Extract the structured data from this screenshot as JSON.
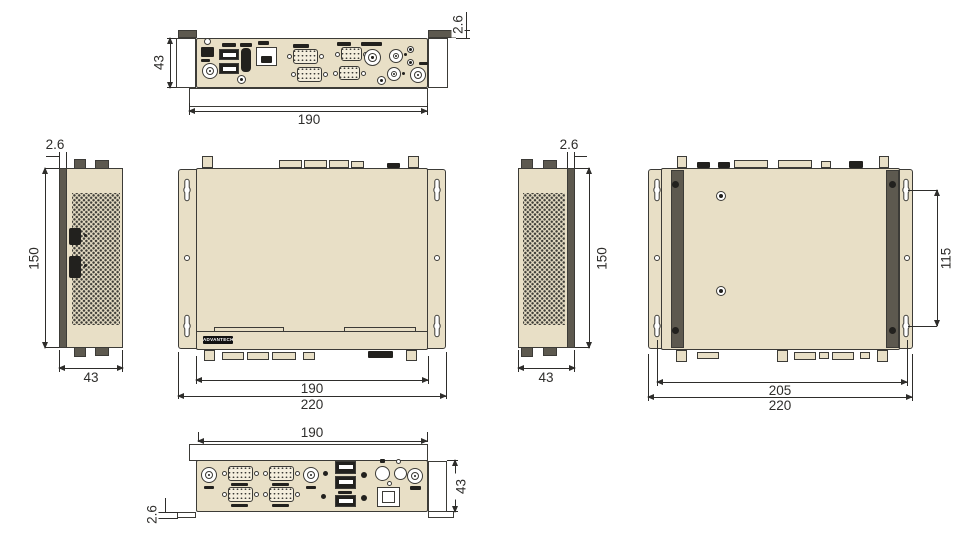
{
  "colors": {
    "background": "#ffffff",
    "chassis_fill": "#e8dfc6",
    "line": "#3c3b37",
    "dark_fill": "#22211e",
    "metal_gray": "#5d594f",
    "dim_color": "#2e2d2b"
  },
  "views": {
    "rear_panel": {
      "width_mm": "190",
      "height_mm": "43",
      "flange_mm": "2.6"
    },
    "left_side": {
      "flange_mm": "2.6",
      "height_mm": "150",
      "depth_mm": "43"
    },
    "top": {
      "width_mm": "190",
      "overall_width_mm": "220",
      "logo_text": "ADVANTECH"
    },
    "right_side": {
      "flange_mm": "2.6",
      "height_mm": "150",
      "depth_mm": "43"
    },
    "bottom": {
      "mount_pitch_v_mm": "115",
      "mount_pitch_h_mm": "205",
      "overall_width_mm": "220"
    },
    "front_panel": {
      "width_mm": "190",
      "height_mm": "43",
      "flange_mm": "2.6"
    }
  }
}
